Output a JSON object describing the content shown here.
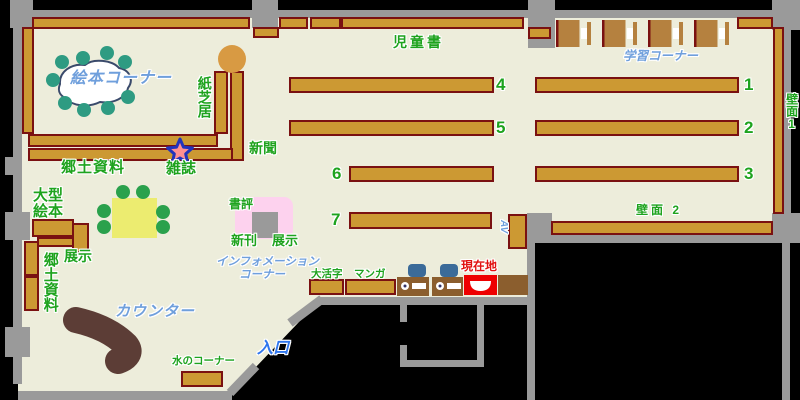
{
  "map_type": "library-floor-map",
  "labels": {
    "jidosho": "児童書",
    "ehon_corner": "絵本コーナー",
    "kamishibai": "紙芝居",
    "gakushu_corner": "学習コーナー",
    "hekimen1": "壁面1",
    "hekimen2": "壁面 2",
    "shinbun": "新聞",
    "zasshi": "雑誌",
    "kyodo_shiryo_top": "郷土資料",
    "ogata_line1": "大型",
    "ogata_line2": "絵本",
    "tenji_left": "展示",
    "kyodo_shiryo_vert": "郷土資料",
    "shohyo": "書評",
    "shinkan": "新刊",
    "tenji_center": "展示",
    "info_line1": "インフォメーション",
    "info_line2": "コーナー",
    "daikatsuji": "大活字",
    "manga": "マンガ",
    "genzaichi": "現在地",
    "av": "AV",
    "counter": "カウンター",
    "mizu_corner": "水のコーナー",
    "iriguchi": "入口"
  },
  "numbers": {
    "r1": "1",
    "r2": "2",
    "r3": "3",
    "r4": "4",
    "r5": "5",
    "r6": "6",
    "r7": "7"
  },
  "colors": {
    "floor": "#ededdb",
    "wall_gray": "#9a9a9a",
    "outside_black": "#000000",
    "shelf_fill": "#cc9933",
    "shelf_border": "#7a1111",
    "study_desk": "#b5813f",
    "opac_desk": "#8b5e2e",
    "counter_brown": "#5c3d36",
    "table_yellow": "#ecec70",
    "stool_teal": "#2e9b82",
    "chair_green": "#2aa14c",
    "round_table_orange": "#d89a43",
    "display_pink": "#fdd2ee",
    "text_green": "#1ea31e",
    "text_blue": "#6f9fdc",
    "entrance_blue": "#2f76ee",
    "current_red": "#e11111",
    "chair_blue": "#3b6b99",
    "star_fill": "#ff9090",
    "star_border": "#2233bb"
  }
}
